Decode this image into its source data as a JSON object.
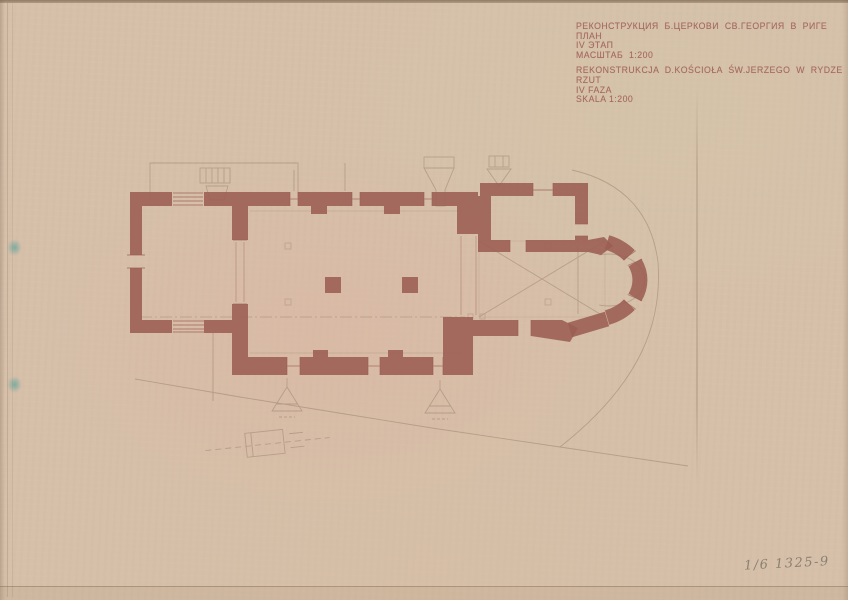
{
  "document": {
    "kind": "scanned architectural drawing sheet",
    "title_block": {
      "ru": [
        "РЕКОНСТРУКЦИЯ  Б.ЦЕРКОВИ  СВ.ГЕОРГИЯ  В  РИГЕ",
        "ПЛАН",
        "IV ЭТАП",
        "МАСШТАБ  1:200"
      ],
      "pl": [
        "REKONSTRUKCJA  D.KOŚCIOŁA  ŚW.JERZEGO  W  RYDZE",
        "RZUT",
        "IV FAZA",
        "SKALA 1:200"
      ]
    },
    "annotations": {
      "inventory_number": "1/6 1325-9"
    },
    "plan": {
      "type": "church floor plan",
      "scale": "1:200",
      "building_parts": [
        "west-tower",
        "nave",
        "chancel",
        "sacristy",
        "semicircular-apse",
        "nave-pillars",
        "buttresses",
        "site-boundary"
      ]
    },
    "colors": {
      "paper": "#d6c0aa",
      "wall_ink": "#9c5e53",
      "pencil": "#9b8570",
      "tape_mark": "#5fa39b",
      "handwriting": "#7e7668"
    }
  }
}
